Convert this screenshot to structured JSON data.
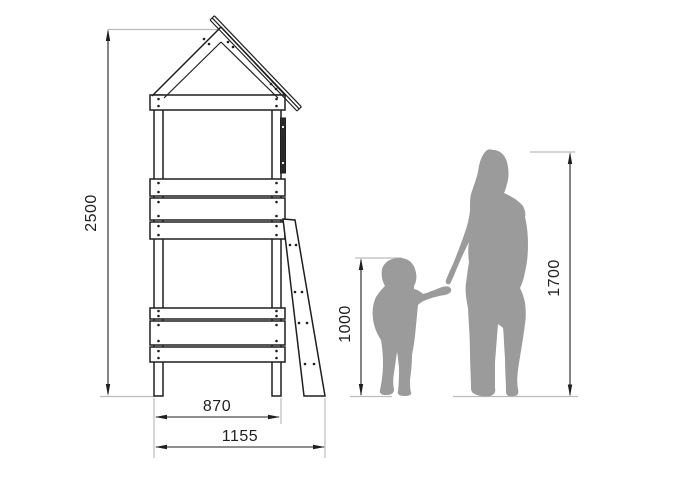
{
  "diagram": {
    "kind": "technical-dimension-drawing",
    "subject": "play tower with gabled roof and ladder, side elevation, with adult and child silhouettes for scale",
    "dimensions": {
      "total_height": "2500",
      "leg_span": "870",
      "overall_width": "1155",
      "child_height": "1000",
      "adult_height": "1700"
    },
    "colors": {
      "background": "#ffffff",
      "drawing_line": "#1f1f1f",
      "extension_line": "#bcbcbc",
      "silhouette_gray": "#9b9b9b"
    }
  }
}
